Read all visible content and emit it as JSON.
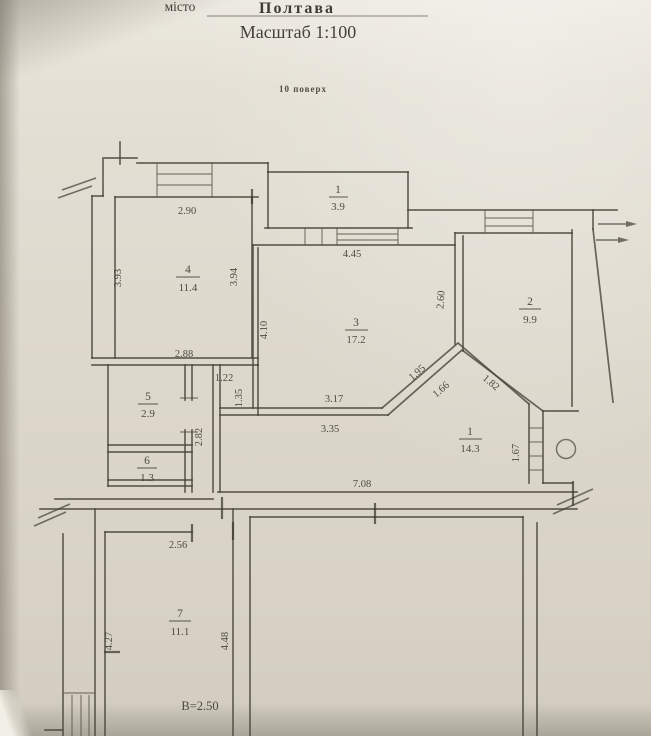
{
  "header": {
    "city_label": "місто",
    "city_name": "Полтава",
    "scale_text": "Масштаб 1:100",
    "floor_text": "10 поверх"
  },
  "rooms": {
    "balcony": {
      "number": "1",
      "area": "3.9"
    },
    "room2": {
      "number": "2",
      "area": "9.9"
    },
    "room3": {
      "number": "3",
      "area": "17.2"
    },
    "room4": {
      "number": "4",
      "area": "11.4"
    },
    "room5": {
      "number": "5",
      "area": "2.9"
    },
    "room6": {
      "number": "6",
      "area": "1.3"
    },
    "room7": {
      "number": "7",
      "area": "11.1"
    },
    "corridor": {
      "number": "1",
      "area": "14.3"
    }
  },
  "dims": {
    "room4_top": "2.90",
    "room4_left": "3.93",
    "room4_right": "3.94",
    "room3_top": "4.45",
    "room3_left": "4.10",
    "room3_right": "2.60",
    "room5_top": "2.88",
    "hall_width": "1.22",
    "hall_depth": "1.35",
    "hall_vert": "2.82",
    "corridor_wall_a": "3.17",
    "corridor_wall_b": "3.35",
    "diagonal_a": "1.95",
    "diagonal_b": "1.66",
    "diagonal_c": "1.82",
    "corridor_right": "1.67",
    "corridor_bottom": "7.08",
    "room7_top": "2.56",
    "room7_left": "4.27",
    "room7_right": "4.48",
    "ceiling_height": "В=2.50"
  },
  "colors": {
    "ink": "#4b473c",
    "paper_light": "#ece9e0",
    "paper_dark": "#d2cdc0"
  }
}
